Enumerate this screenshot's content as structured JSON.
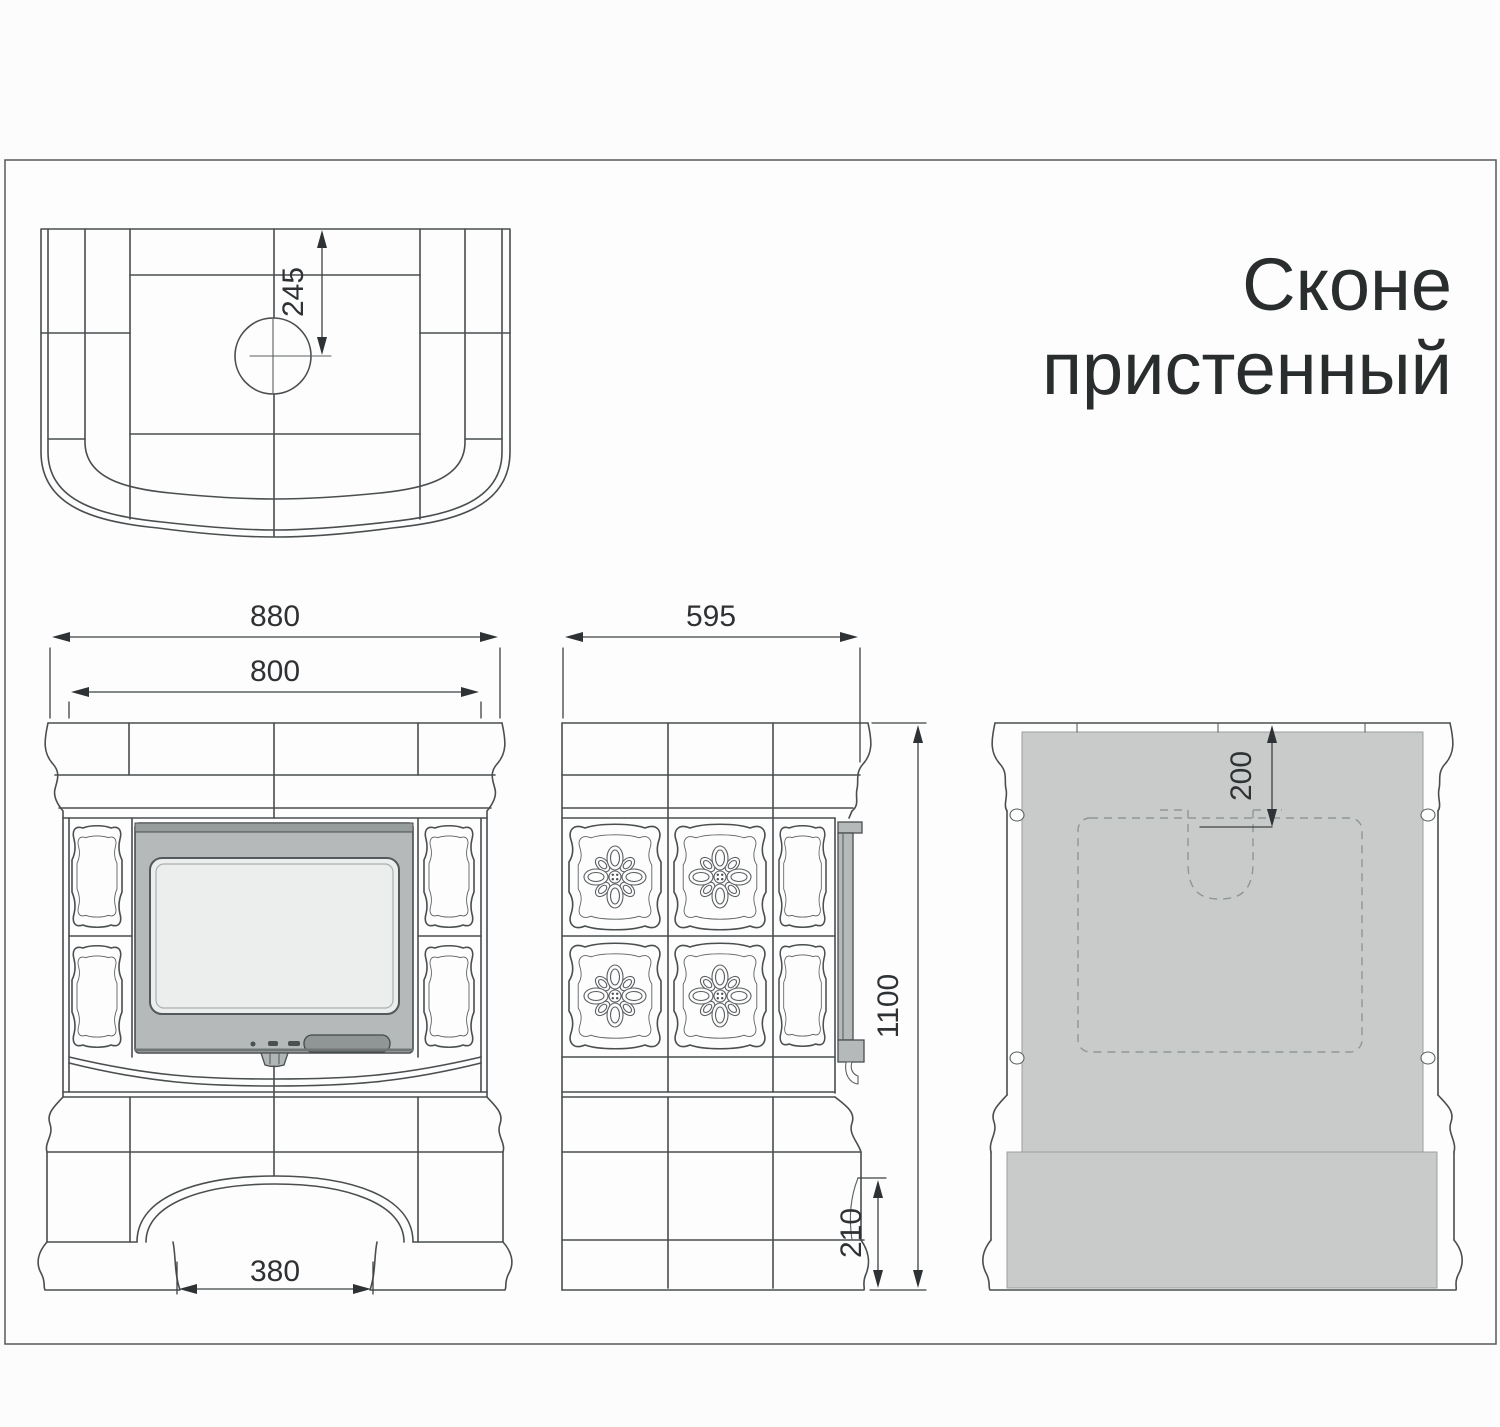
{
  "title": {
    "line1": "Сконе",
    "line2": "пристенный"
  },
  "dimensions": {
    "flue_center_from_back": "245",
    "front_overall_width": "880",
    "front_body_width": "800",
    "arch_opening_width": "380",
    "side_depth": "595",
    "overall_height": "1100",
    "plinth_height": "210",
    "flue_top_offset": "200"
  },
  "colors": {
    "line": "#4a4e50",
    "dimension_line": "#3e4244",
    "text": "#2f3234",
    "door_frame": "#b5b9b9",
    "door_glass": "#eceeed",
    "door_lever": "#8f9695",
    "back_panel": "#c8cbca",
    "background": "#fcfcfc"
  }
}
